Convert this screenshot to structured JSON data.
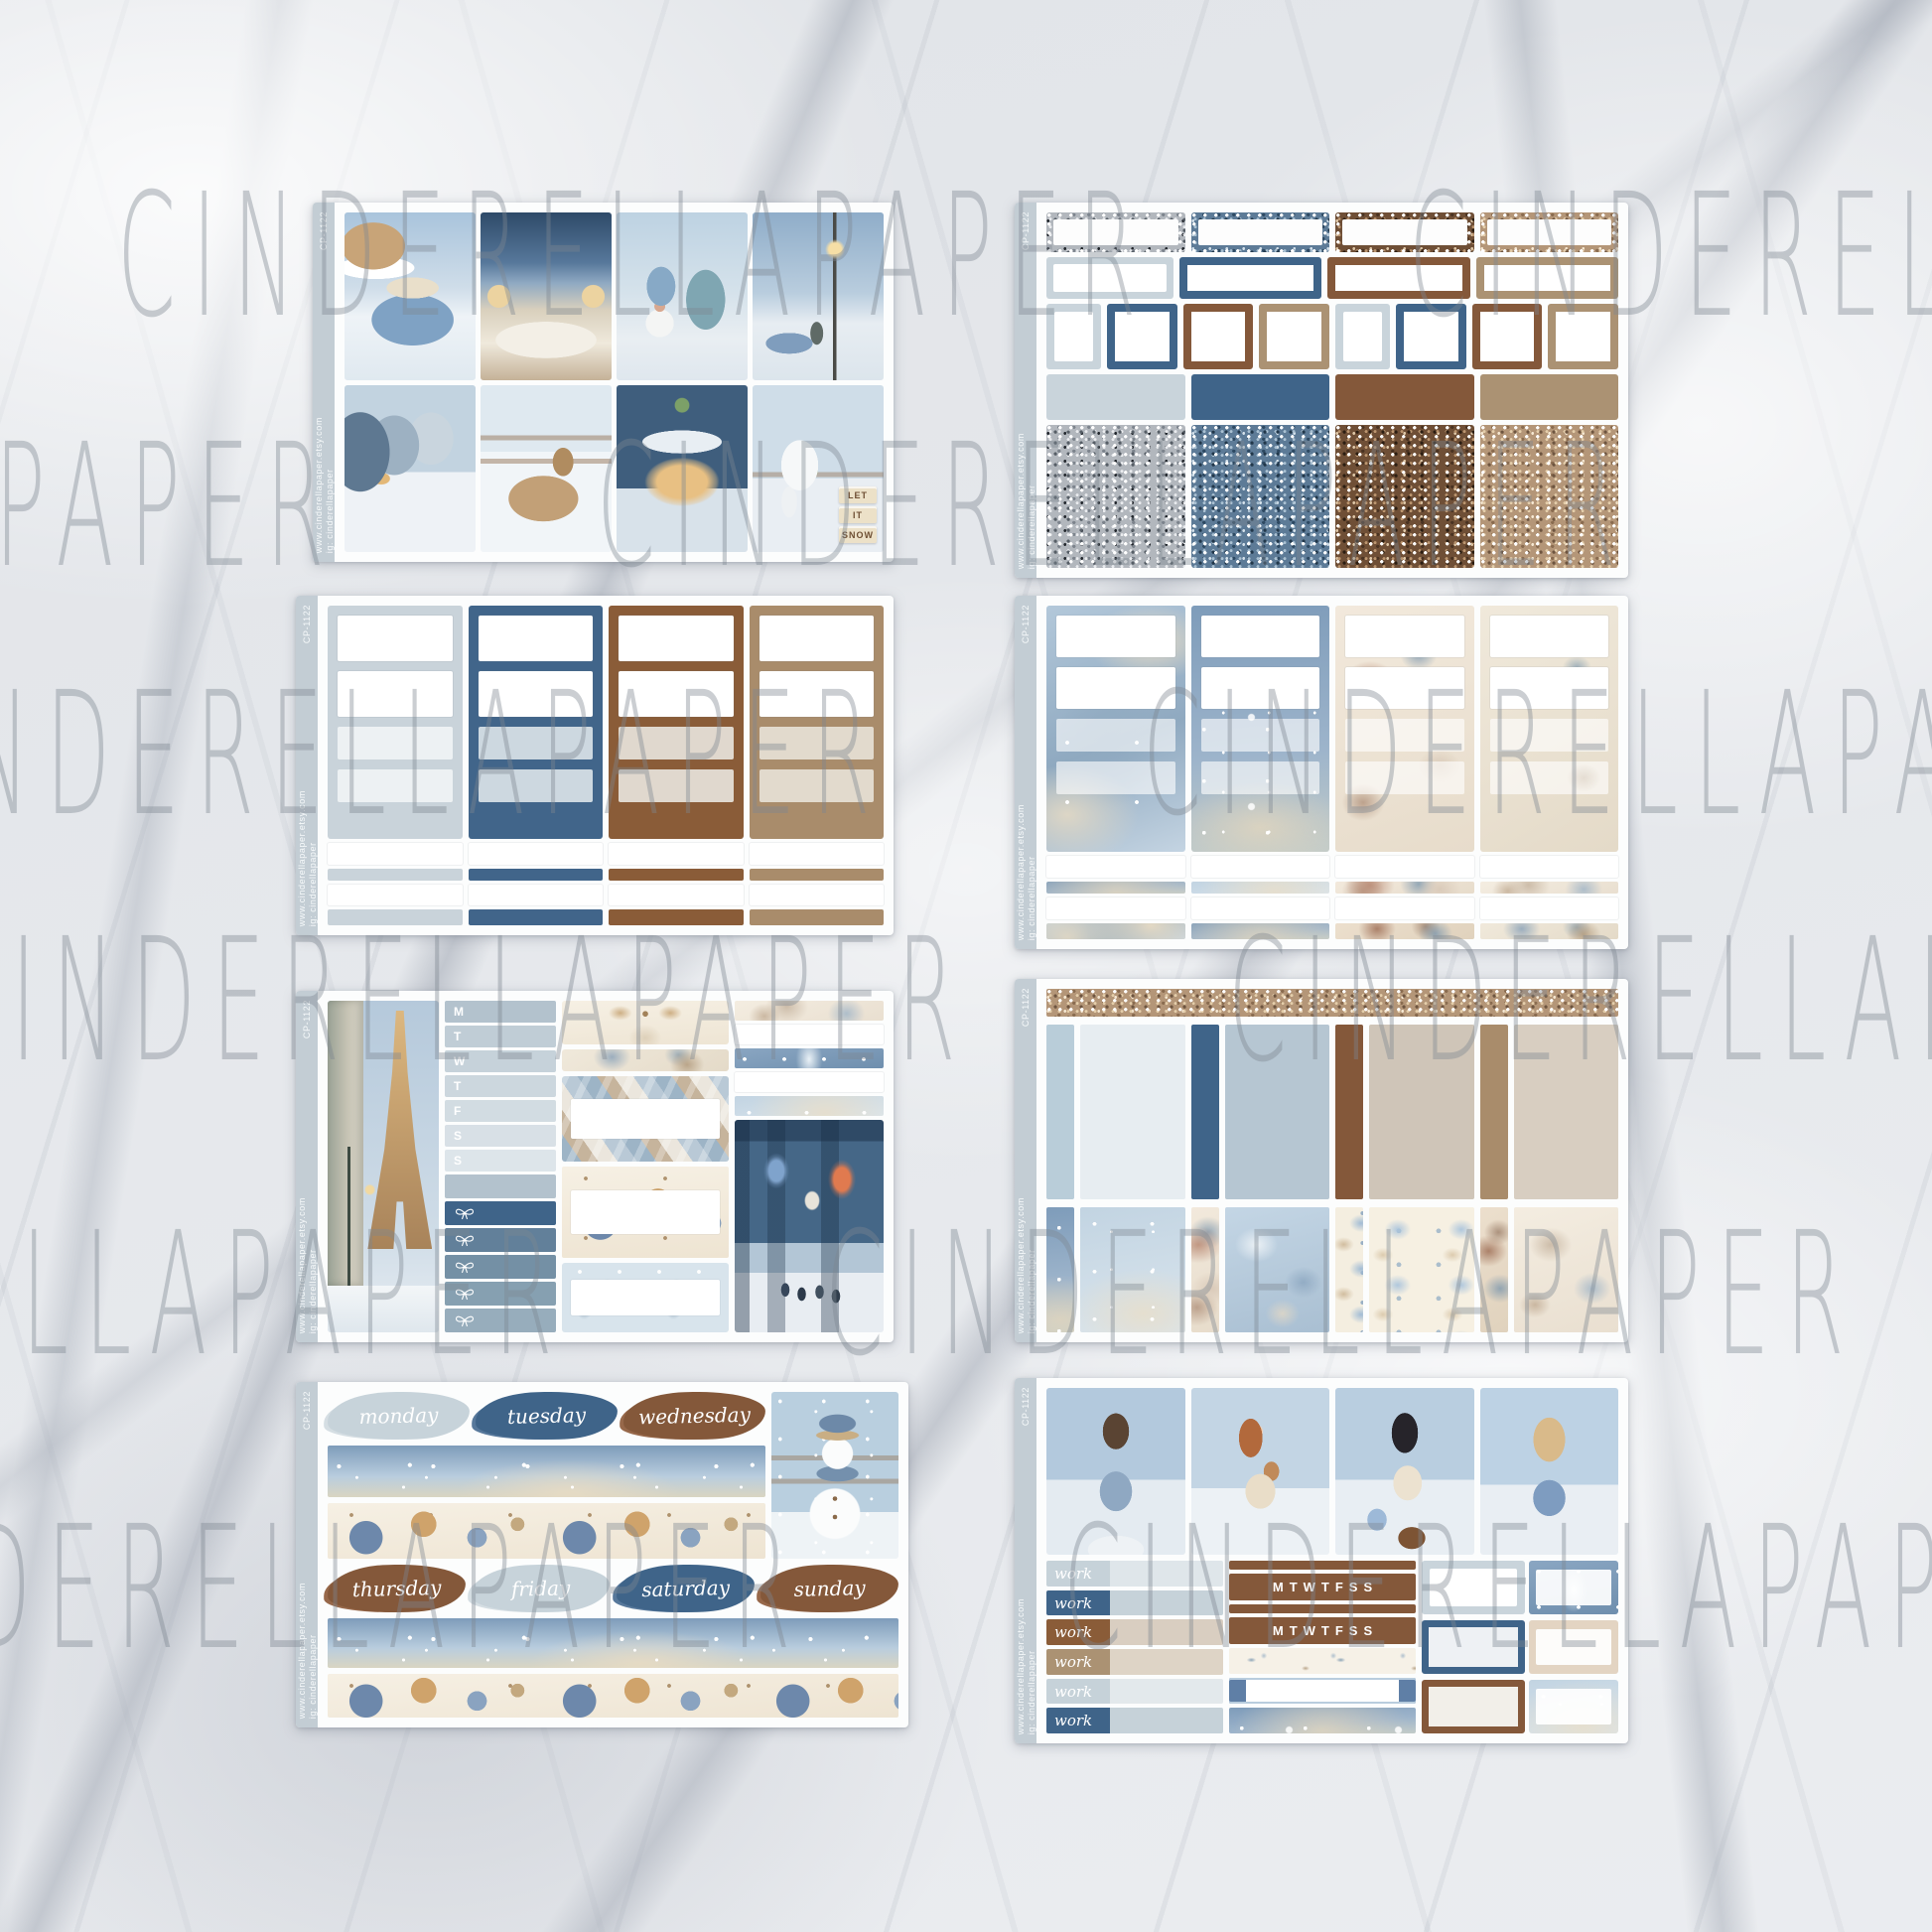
{
  "product": {
    "watermark_text": "CINDERELLAPAPER",
    "kit_theme": "winter blue and brown planner sticker kit"
  },
  "sidebar": {
    "code": "CP-1122",
    "site": "www.cinderellapaper.etsy.com",
    "instagram": "ig: cinderellapaper"
  },
  "palette": {
    "pale_blue": "#c9d4db",
    "powder_blue": "#dfe7ec",
    "steel_blue": "#8ba3b5",
    "dark_blue": "#3f6489",
    "brown": "#84583a",
    "tan": "#ab9273",
    "taupe": "#cfc5b8",
    "beige": "#e9e2d6",
    "glitter_silver": "#b2b7bd",
    "glitter_blue": "#5d7b97",
    "glitter_brown": "#6f4f36",
    "glitter_gold": "#b49678",
    "tab_strip": "#c3cdd4",
    "paper": "#fcfdfd"
  },
  "sheet1": {
    "boxes": [
      "snowy-house-gift-truck",
      "winter-bedroom-city-window",
      "gnome-with-blue-tree",
      "street-lamp-evening-walk",
      "snowy-town-street",
      "deer-resting-by-fence",
      "christmas-cafe-lights",
      "rocking-horse-snow-blocks"
    ],
    "caption_blocks": [
      "LET",
      "IT",
      "SNOW"
    ]
  },
  "sheet5": {
    "habit_letters": [
      "M",
      "T",
      "W",
      "T",
      "F",
      "S",
      "S"
    ]
  },
  "sheet7": {
    "days_row1": [
      "monday",
      "tuesday",
      "wednesday"
    ],
    "days_row2": [
      "thursday",
      "friday",
      "saturday",
      "sunday"
    ]
  },
  "sheet8": {
    "girls": [
      "brunette-earmuffs",
      "redhead-with-fawn",
      "shopper-with-gift-bag",
      "blonde-with-snowball"
    ],
    "work_labels": [
      "work",
      "work",
      "work",
      "work",
      "work",
      "work"
    ],
    "week_strips": [
      "MTWTFSS",
      "MTWTFSS"
    ]
  }
}
